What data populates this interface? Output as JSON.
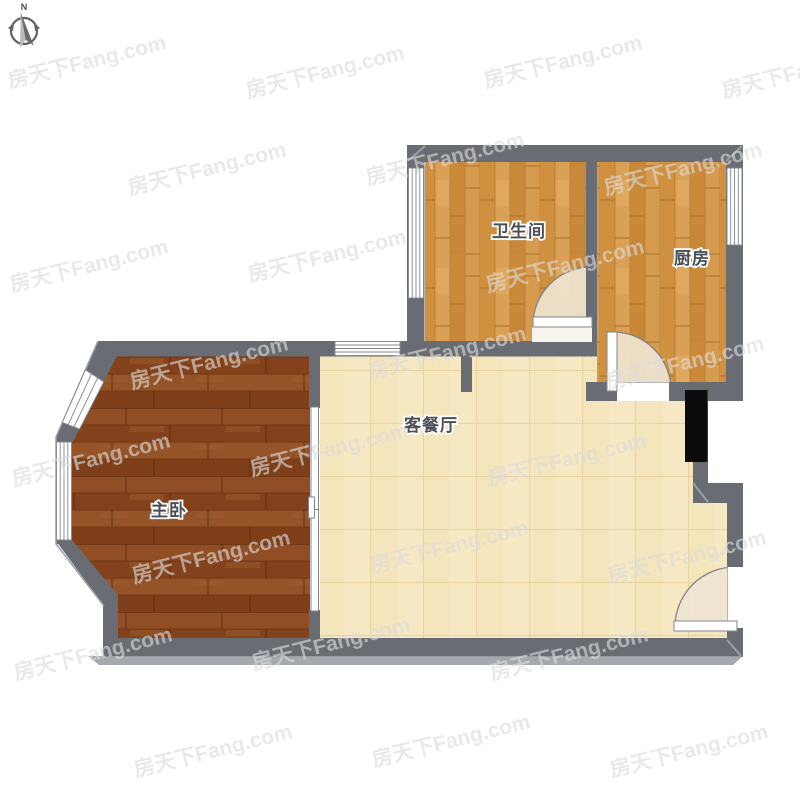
{
  "compass": {
    "label": "N"
  },
  "watermark": {
    "text": "房天下Fang.com"
  },
  "rooms": [
    {
      "id": "bathroom",
      "label": "卫生间"
    },
    {
      "id": "kitchen",
      "label": "厨房"
    },
    {
      "id": "living-dining",
      "label": "客餐厅"
    },
    {
      "id": "master-bedroom",
      "label": "主卧"
    }
  ],
  "colors": {
    "wall": "#696d73",
    "wall_edge": "#9aa0a6",
    "wood_floor": "#d49849",
    "bedroom_floor": "#8c4a21",
    "tile_floor": "#f6e8c2",
    "door_swing": "#efe5d1",
    "door_arc": "#7f838a",
    "window": "#ffffff",
    "shaft_block": "#0b0b0c",
    "label_text": "#4b5057",
    "watermark": "#dcdcdc",
    "background": "#ffffff"
  }
}
